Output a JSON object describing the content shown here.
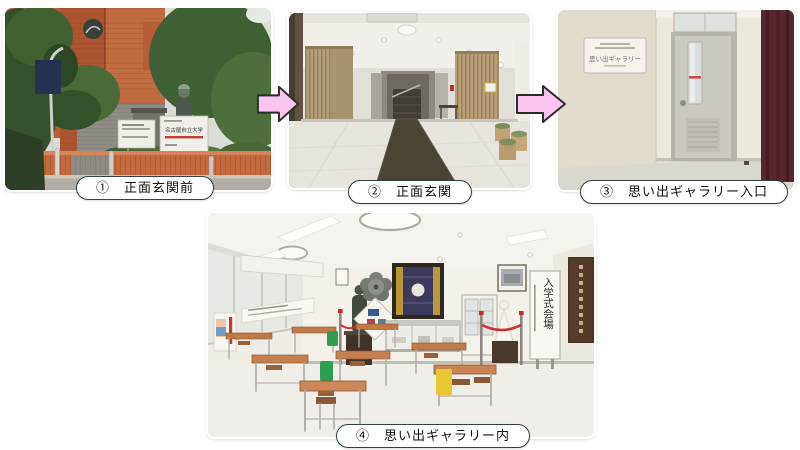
{
  "captions": [
    "①　正面玄関前",
    "②　正面玄関",
    "③　思い出ギャラリー入口",
    "④　思い出ギャラリー内"
  ],
  "signs": {
    "university": "名古屋市立大学",
    "gallery": "思い出ギャラリー",
    "ceremony": "入学式会場"
  },
  "arrows": {
    "direction": "right",
    "count": 2,
    "fill": "#f7c5ef",
    "outline": "#2b2b2b"
  },
  "photos": [
    {
      "id": 1,
      "caption": "①　正面玄関前",
      "alt": "brick university building exterior with trees, bronze statue and signboards"
    },
    {
      "id": 2,
      "caption": "②　正面玄関",
      "alt": "entrance lobby with wooden slat pillars, dark carpet runner and staircase"
    },
    {
      "id": 3,
      "caption": "③　思い出ギャラリー入口",
      "alt": "gray door with narrow window and memory gallery wall sign"
    },
    {
      "id": 4,
      "caption": "④　思い出ギャラリー内",
      "alt": "gallery room with old school desks, bags, exhibits and entrance-ceremony sign"
    }
  ],
  "style": {
    "background": "#ffffff",
    "caption_border": "#2e4145",
    "caption_background": "#ffffff",
    "caption_text": "#111111"
  }
}
